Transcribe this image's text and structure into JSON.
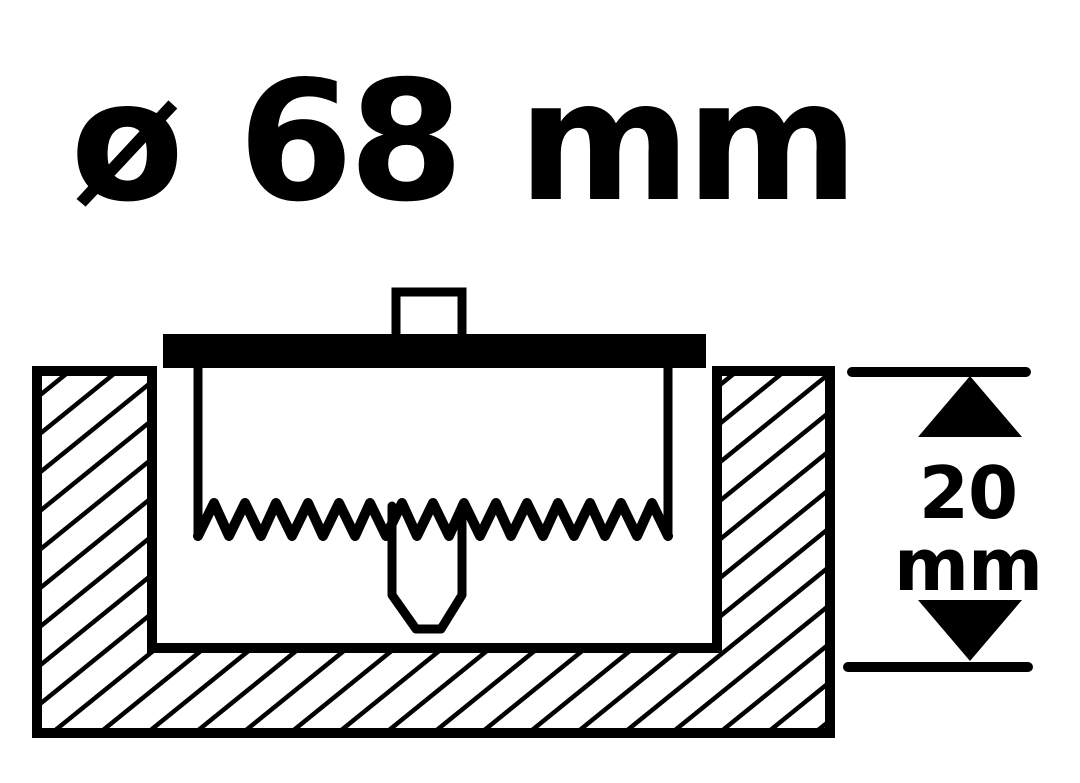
{
  "title": {
    "text": "ø 68 mm"
  },
  "depth_dimension": {
    "value": "20",
    "unit": "mm"
  },
  "icons": {
    "arrow_up": "▲",
    "arrow_down": "▼"
  },
  "colors": {
    "ink": "#000000",
    "background": "#ffffff"
  }
}
